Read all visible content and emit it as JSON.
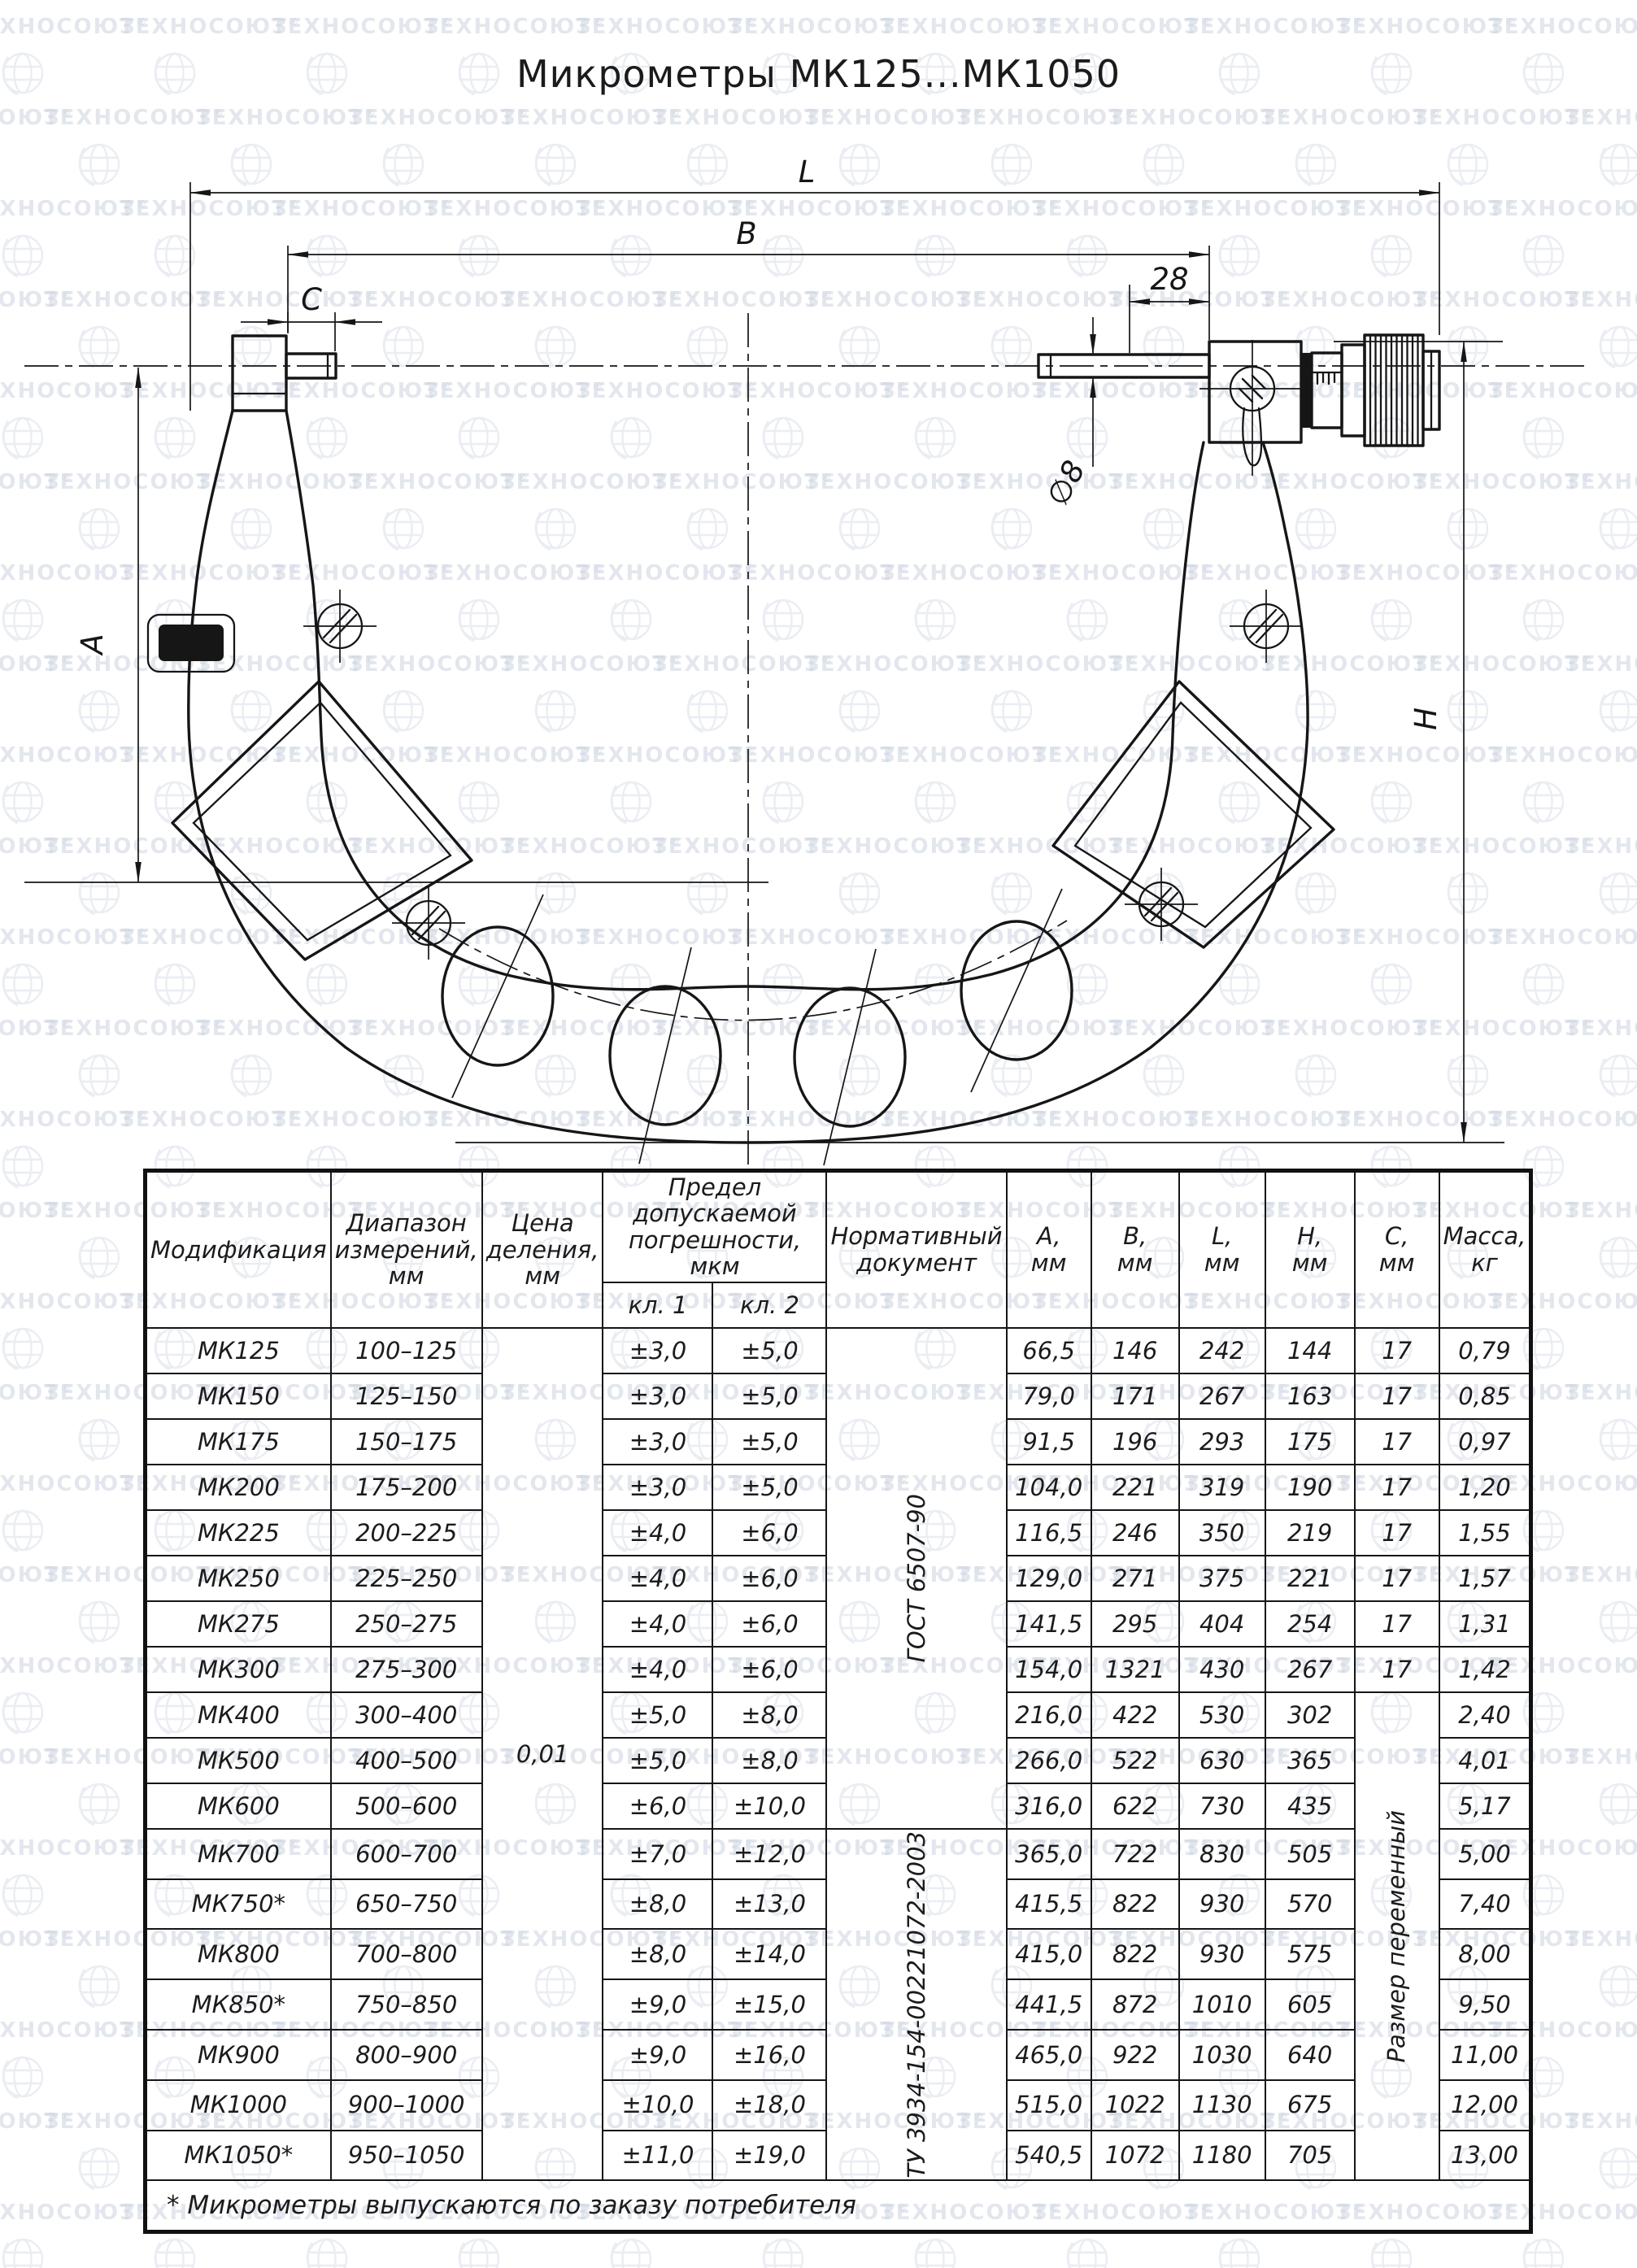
{
  "watermark": {
    "text": "ТЕХНОСОЮЗ",
    "reg": "®"
  },
  "title": "Микрометры МК125...МК1050",
  "drawing": {
    "labels": {
      "L": "L",
      "B": "B",
      "C": "C",
      "len28": "28",
      "dia8": "∅8",
      "A": "A",
      "H": "H"
    }
  },
  "table": {
    "header": {
      "model": "Модификация",
      "range": "Диапазон измерений, мм",
      "division": "Цена деления, мм",
      "tolerance": "Предел допускаемой погрешности, мкм",
      "class1": "кл. 1",
      "class2": "кл. 2",
      "document": "Нормативный документ",
      "dims": [
        [
          "A,",
          "мм"
        ],
        [
          "B,",
          "мм"
        ],
        [
          "L,",
          "мм"
        ],
        [
          "H,",
          "мм"
        ],
        [
          "C,",
          "мм"
        ],
        [
          "Масса,",
          "кг"
        ]
      ]
    },
    "merges": {
      "division": "0,01",
      "doc1": "ГОСТ 6507-90",
      "doc1_rows": 11,
      "doc2": "ТУ 3934-154-00221072-2003",
      "doc2_rows": 7,
      "c_variable": "Размер переменный",
      "c_variable_rows": 10
    },
    "rows": [
      [
        "МК125",
        "100–125",
        "±3,0",
        "±5,0",
        "66,5",
        "146",
        "242",
        "144",
        "17",
        "0,79"
      ],
      [
        "МК150",
        "125–150",
        "±3,0",
        "±5,0",
        "79,0",
        "171",
        "267",
        "163",
        "17",
        "0,85"
      ],
      [
        "МК175",
        "150–175",
        "±3,0",
        "±5,0",
        "91,5",
        "196",
        "293",
        "175",
        "17",
        "0,97"
      ],
      [
        "МК200",
        "175–200",
        "±3,0",
        "±5,0",
        "104,0",
        "221",
        "319",
        "190",
        "17",
        "1,20"
      ],
      [
        "МК225",
        "200–225",
        "±4,0",
        "±6,0",
        "116,5",
        "246",
        "350",
        "219",
        "17",
        "1,55"
      ],
      [
        "МК250",
        "225–250",
        "±4,0",
        "±6,0",
        "129,0",
        "271",
        "375",
        "221",
        "17",
        "1,57"
      ],
      [
        "МК275",
        "250–275",
        "±4,0",
        "±6,0",
        "141,5",
        "295",
        "404",
        "254",
        "17",
        "1,31"
      ],
      [
        "МК300",
        "275–300",
        "±4,0",
        "±6,0",
        "154,0",
        "1321",
        "430",
        "267",
        "17",
        "1,42"
      ],
      [
        "МК400",
        "300–400",
        "±5,0",
        "±8,0",
        "216,0",
        "422",
        "530",
        "302",
        null,
        "2,40"
      ],
      [
        "МК500",
        "400–500",
        "±5,0",
        "±8,0",
        "266,0",
        "522",
        "630",
        "365",
        null,
        "4,01"
      ],
      [
        "МК600",
        "500–600",
        "±6,0",
        "±10,0",
        "316,0",
        "622",
        "730",
        "435",
        null,
        "5,17"
      ],
      [
        "МК700",
        "600–700",
        "±7,0",
        "±12,0",
        "365,0",
        "722",
        "830",
        "505",
        null,
        "5,00"
      ],
      [
        "МК750*",
        "650–750",
        "±8,0",
        "±13,0",
        "415,5",
        "822",
        "930",
        "570",
        null,
        "7,40"
      ],
      [
        "МК800",
        "700–800",
        "±8,0",
        "±14,0",
        "415,0",
        "822",
        "930",
        "575",
        null,
        "8,00"
      ],
      [
        "МК850*",
        "750–850",
        "±9,0",
        "±15,0",
        "441,5",
        "872",
        "1010",
        "605",
        null,
        "9,50"
      ],
      [
        "МК900",
        "800–900",
        "±9,0",
        "±16,0",
        "465,0",
        "922",
        "1030",
        "640",
        null,
        "11,00"
      ],
      [
        "МК1000",
        "900–1000",
        "±10,0",
        "±18,0",
        "515,0",
        "1022",
        "1130",
        "675",
        null,
        "12,00"
      ],
      [
        "МК1050*",
        "950–1050",
        "±11,0",
        "±19,0",
        "540,5",
        "1072",
        "1180",
        "705",
        null,
        "13,00"
      ]
    ],
    "footnote": "* Микрометры выпускаются по заказу потребителя"
  }
}
